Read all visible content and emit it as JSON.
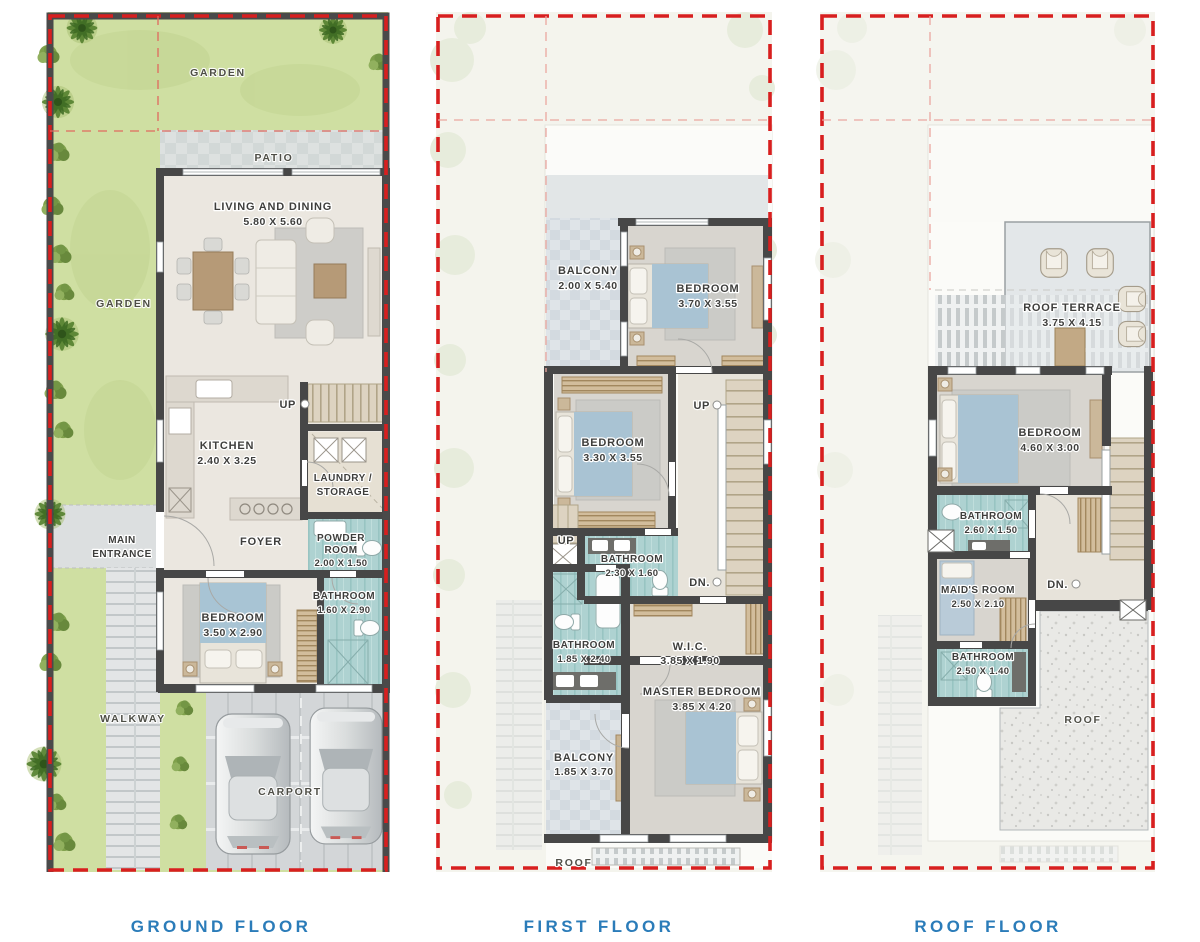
{
  "meta": {
    "image_type": "architectural floor plans, 3 panels"
  },
  "colors": {
    "caption_blue": "#2b7cb9",
    "boundary_red": "#d81f1f",
    "wall_dark": "#474747",
    "garden_green": "#cfdfa2",
    "wet_room_teal": "#aed2d1",
    "floor_beige": "#ebe7e0"
  },
  "captions": {
    "ground": "GROUND FLOOR",
    "first": "FIRST FLOOR",
    "roof": "ROOF FLOOR"
  },
  "ground": {
    "garden_top": "GARDEN",
    "garden_left": "GARDEN",
    "patio": "PATIO",
    "living_name": "LIVING AND DINING",
    "living_dims": "5.80 X 5.60",
    "kitchen_name": "KITCHEN",
    "kitchen_dims": "2.40 X 3.25",
    "up": "UP",
    "laundry_line1": "LAUNDRY /",
    "laundry_line2": "STORAGE",
    "entrance_line1": "MAIN",
    "entrance_line2": "ENTRANCE",
    "foyer": "FOYER",
    "powder_line1": "POWDER",
    "powder_line2": "ROOM",
    "powder_dims": "2.00 X 1.50",
    "bathroom_name": "BATHROOM",
    "bathroom_dims": "1.60 X 2.90",
    "bedroom_name": "BEDROOM",
    "bedroom_dims": "3.50 X 2.90",
    "walkway": "WALKWAY",
    "carport": "CARPORT"
  },
  "first": {
    "balcony1_name": "BALCONY",
    "balcony1_dims": "2.00 X 5.40",
    "bedroom1_name": "BEDROOM",
    "bedroom1_dims": "3.70 X 3.55",
    "bedroom2_name": "BEDROOM",
    "bedroom2_dims": "3.30 X 3.55",
    "up_stairs": "UP",
    "up_steps": "UP",
    "down": "DN.",
    "bathroom1_name": "BATHROOM",
    "bathroom1_dims": "2.30 X 1.60",
    "bathroom2_name": "BATHROOM",
    "bathroom2_dims": "1.85 X 2.40",
    "wic_name": "W.I.C.",
    "wic_dims": "3.85 X 1.90",
    "master_name": "MASTER BEDROOM",
    "master_dims": "3.85 X 4.20",
    "balcony2_name": "BALCONY",
    "balcony2_dims": "1.85 X 3.70",
    "roof_strip": "ROOF"
  },
  "roof": {
    "terrace_name": "ROOF TERRACE",
    "terrace_dims": "3.75 X 4.15",
    "bedroom_name": "BEDROOM",
    "bedroom_dims": "4.60 X 3.00",
    "bathroom1_name": "BATHROOM",
    "bathroom1_dims": "2.60 X 1.50",
    "maid_name": "MAID'S ROOM",
    "maid_dims": "2.50 X 2.10",
    "down": "DN.",
    "bathroom2_name": "BATHROOM",
    "bathroom2_dims": "2.50 X 1.40",
    "roof_area": "ROOF"
  }
}
